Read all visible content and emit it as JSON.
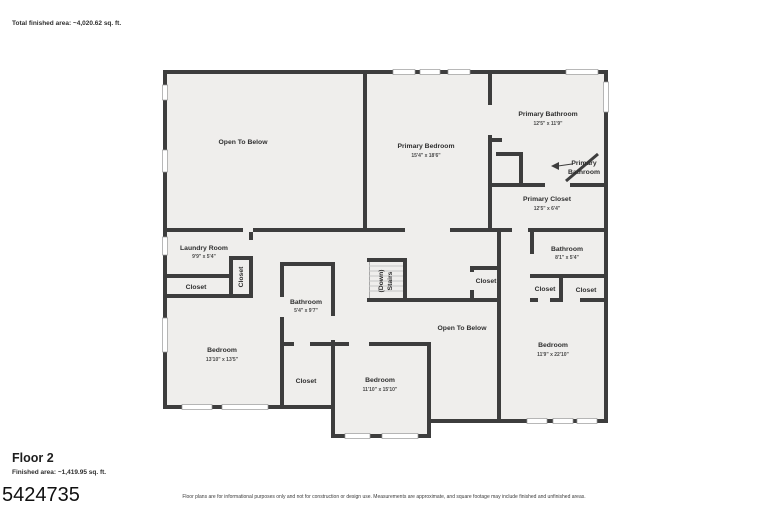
{
  "header": {
    "total_area": "Total finished area: ~4,020.62 sq. ft."
  },
  "floor": {
    "name": "Floor 2",
    "finished_area": "Finished area: ~1,419.95 sq. ft."
  },
  "listing_number": "5424735",
  "disclaimer": "Floor plans are for informational purposes only and not for construction or design use. Measurements are approximate, and square footage may include finished and unfinished areas.",
  "rooms": {
    "open_to_below_upper": {
      "label": "Open To Below"
    },
    "primary_bedroom": {
      "label": "Primary Bedroom",
      "dims": "15'4\" x 18'6\""
    },
    "primary_bathroom": {
      "label": "Primary Bathroom",
      "dims": "12'5\" x 11'9\""
    },
    "primary_bathroom_callout": {
      "line1": "Primary",
      "line2": "Bathroom"
    },
    "primary_closet": {
      "label": "Primary Closet",
      "dims": "12'5\" x 6'4\""
    },
    "laundry_room": {
      "label": "Laundry Room",
      "dims": "9'9\" x 5'4\""
    },
    "laundry_closet_vertical": {
      "label": "Closet"
    },
    "laundry_closet": {
      "label": "Closet"
    },
    "bathroom_center": {
      "label": "Bathroom",
      "dims": "5'4\" x 9'7\""
    },
    "stairs": {
      "line1": "Stairs",
      "line2": "(Down)"
    },
    "hall_closet": {
      "label": "Closet"
    },
    "open_to_below_center": {
      "label": "Open To Below"
    },
    "bathroom_right": {
      "label": "Bathroom",
      "dims": "8'1\" x 5'4\""
    },
    "closet_right_a": {
      "label": "Closet"
    },
    "closet_right_b": {
      "label": "Closet"
    },
    "bedroom_right": {
      "label": "Bedroom",
      "dims": "11'9\" x 22'10\""
    },
    "bedroom_left": {
      "label": "Bedroom",
      "dims": "13'10\" x 13'5\""
    },
    "closet_lower": {
      "label": "Closet"
    },
    "bedroom_lower": {
      "label": "Bedroom",
      "dims": "11'10\" x 15'10\""
    }
  },
  "colors": {
    "wall": "#3d3d3d",
    "floor_fill": "#efeeec",
    "background": "#ffffff",
    "text": "#2f2f2f"
  }
}
